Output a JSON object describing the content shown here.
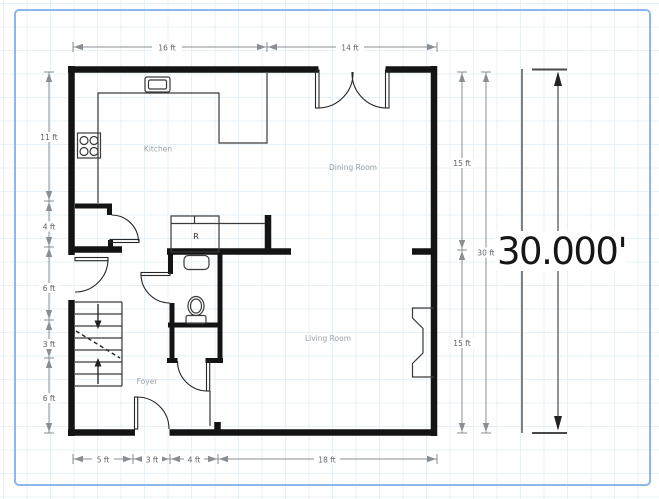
{
  "rooms": {
    "kitchen": "Kitchen",
    "dining": "Dining Room",
    "living": "Living Room",
    "foyer": "Foyer"
  },
  "fixtures": {
    "refrigerator_label": "R"
  },
  "dimensions": {
    "top": [
      "16 ft",
      "14 ft"
    ],
    "left": [
      "11 ft",
      "4 ft",
      "6 ft",
      "3 ft",
      "6 ft"
    ],
    "right": [
      "15 ft",
      "15 ft"
    ],
    "right_overall": "30 ft",
    "bottom": [
      "5 ft",
      "3 ft",
      "4 ft",
      "18 ft"
    ]
  },
  "measurement": {
    "value": "30.000'"
  },
  "colors": {
    "wall": "#141414",
    "dimension": "#8a8e92",
    "dimension_text": "#5f6468",
    "room_label": "#9ba0a4",
    "border": "#8cb6ec",
    "grid": "#e7f0f7",
    "measure_line": "#4a4a4a",
    "measure_text": "#161616"
  }
}
